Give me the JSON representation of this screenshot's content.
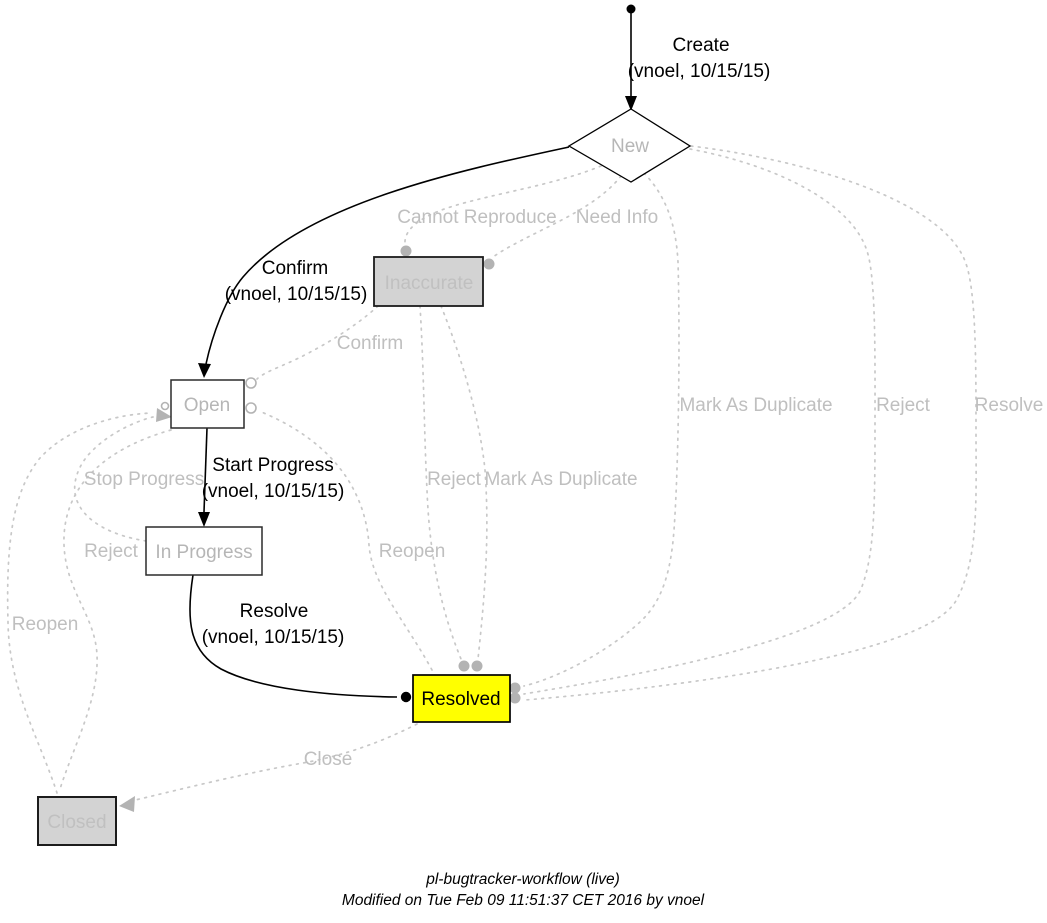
{
  "workflow": {
    "states": {
      "new": {
        "label": "New"
      },
      "inaccurate": {
        "label": "Inaccurate"
      },
      "open": {
        "label": "Open"
      },
      "in_progress": {
        "label": "In Progress"
      },
      "resolved": {
        "label": "Resolved"
      },
      "closed": {
        "label": "Closed"
      }
    },
    "transitions": {
      "create": {
        "label": "Create",
        "by": "(vnoel, 10/15/15)"
      },
      "confirm_taken": {
        "label": "Confirm",
        "by": "(vnoel, 10/15/15)"
      },
      "start_progress_taken": {
        "label": "Start Progress",
        "by": "(vnoel, 10/15/15)"
      },
      "resolve_taken": {
        "label": "Resolve",
        "by": "(vnoel, 10/15/15)"
      },
      "cannot_reproduce": {
        "label": "Cannot Reproduce"
      },
      "need_info": {
        "label": "Need Info"
      },
      "confirm_from_inaccurate": {
        "label": "Confirm"
      },
      "mark_as_duplicate_from_new": {
        "label": "Mark As Duplicate"
      },
      "reject_from_new": {
        "label": "Reject"
      },
      "resolve_from_new": {
        "label": "Resolve"
      },
      "reject_from_inaccurate": {
        "label": "Reject"
      },
      "mark_as_duplicate_from_inaccurate": {
        "label": "Mark As Duplicate"
      },
      "stop_progress": {
        "label": "Stop Progress"
      },
      "reject_to_closed": {
        "label": "Reject"
      },
      "reopen_from_resolved": {
        "label": "Reopen"
      },
      "reopen_from_closed": {
        "label": "Reopen"
      },
      "close": {
        "label": "Close"
      }
    },
    "footer": {
      "title": "pl-bugtracker-workflow (live)",
      "modified": "Modified on Tue Feb 09 11:51:37 CET 2016 by vnoel"
    },
    "colors": {
      "taken_path": "#000000",
      "available_path": "#c8c8c8",
      "available_label": "#bfbfbf",
      "state_label_gray": "#b6b6b6",
      "current_state_fill": "#ffff00",
      "inactive_state_fill": "#d3d3d3",
      "marker_gray": "#b3b3b3"
    }
  }
}
